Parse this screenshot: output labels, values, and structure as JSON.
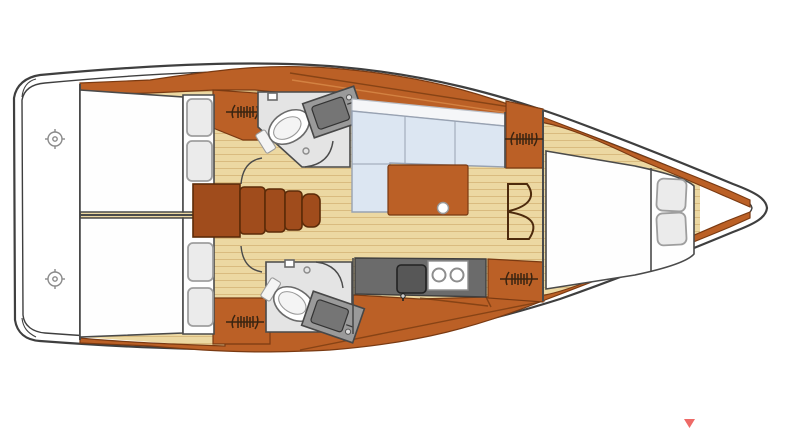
{
  "title": "Sailboat interior layout floor plan (top view, bow to the right)",
  "canvas": {
    "width": 800,
    "height": 446
  },
  "palette": {
    "hull-line": "#3f3f3f",
    "line": "#4a4a4a",
    "wood": "#bb6026",
    "wood-dark": "#a04c1c",
    "wood-border": "#7a3a12",
    "wood-edge": "#5c2b08",
    "wood-light": "#d98b4a",
    "floor": "#ecd8a2",
    "floor-line": "#d9bb7f",
    "settee": "#dce6f2",
    "settee-border": "#98a2b2",
    "backrest": "#f5f6f8",
    "head-floor": "#e4e4e4",
    "counter": "#9a9a9a",
    "counter-inner": "#757575",
    "galley": "#6b6b6b",
    "galley-sink": "#575757",
    "bed": "#fefefe",
    "pillow": "#ebebeb",
    "pillow-border": "#9e9e9e",
    "hatch": "#3a2410",
    "door-line": "#4d2a0d",
    "marker-red": "#ee6a67"
  },
  "rooms": [
    {
      "name": "cockpit-stern",
      "side": "aft"
    },
    {
      "name": "aft-cabin-starboard",
      "furniture": [
        "double-bed",
        "pillows",
        "hatch",
        "door"
      ]
    },
    {
      "name": "aft-cabin-port",
      "furniture": [
        "double-bed",
        "pillows",
        "hatch",
        "door"
      ]
    },
    {
      "name": "companionway",
      "furniture": [
        "engine-box",
        "steps"
      ]
    },
    {
      "name": "head-forward",
      "furniture": [
        "toilet",
        "sink",
        "door"
      ]
    },
    {
      "name": "head-aft",
      "furniture": [
        "toilet",
        "sink",
        "door"
      ]
    },
    {
      "name": "salon",
      "furniture": [
        "l-settee",
        "table"
      ]
    },
    {
      "name": "galley",
      "furniture": [
        "sink",
        "two-burner-stove",
        "counter"
      ]
    },
    {
      "name": "forward-cabin",
      "furniture": [
        "island-bed",
        "pillows",
        "double-doors",
        "hatches"
      ]
    }
  ],
  "icons": [
    "hatch-icon",
    "helm-wheel-icon",
    "door-swing-arc",
    "toilet-icon",
    "sink-icon",
    "stove-burners-icon",
    "page-marker-triangle"
  ],
  "marker": {
    "shape": "triangle-down",
    "color": "#ee6a67"
  }
}
